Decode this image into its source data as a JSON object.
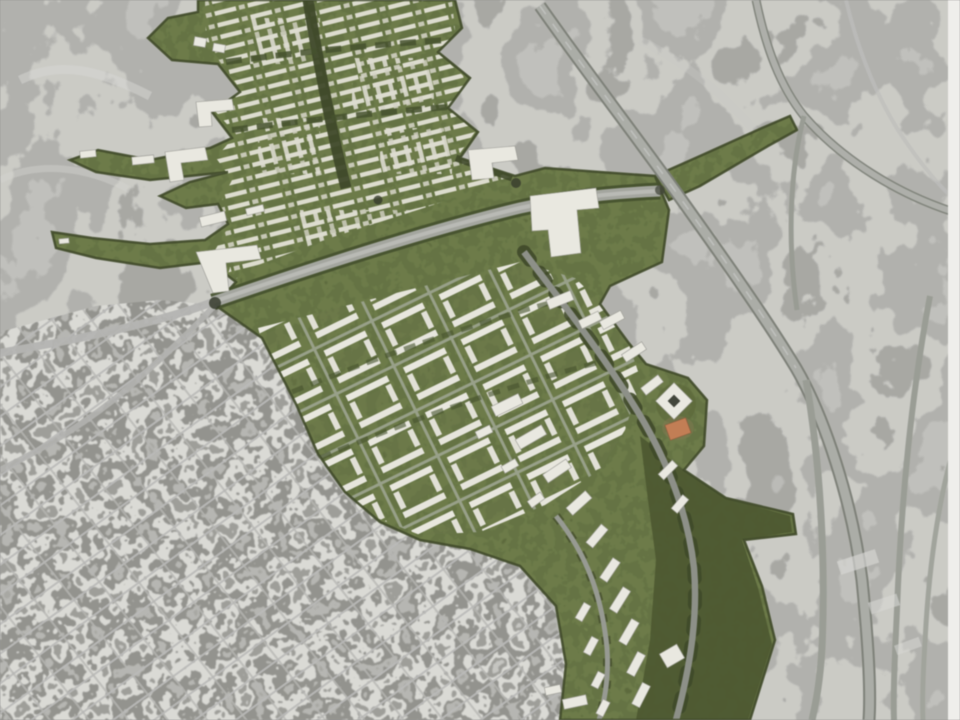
{
  "scene": {
    "kind": "aerial-masterplan-rendering",
    "aria_label": "Bird's-eye aerial rendering: proposed green development corridor with white buildings overlaid on a grayscale aerial photograph of a city, hills and freeways"
  },
  "palette": {
    "terrain_gray": "#b3b2af",
    "urban_gray": "#a9a9a6",
    "freeway_gray": "#abada7",
    "freeway_edge": "#7e8179",
    "arterial_gray": "#a4a69f",
    "plan_green": "#75804d",
    "tree_green": "#3f4a28",
    "woodland_green": "#4d5930",
    "building_white": "#eae9e1",
    "accent_orange": "#c47e53",
    "right_edge_strip": "#f0efec"
  },
  "features": {
    "hills_northwest": "undeveloped hills",
    "freeway_east": "freeway corridor and interchange ramps",
    "city_southwest": "existing dense city fabric",
    "plan_upper_grid": "proposed fine residential grid with tree boulevard",
    "plan_central_blocks": "proposed perimeter-block quarter",
    "plan_south_boulevard": "proposed curving boulevard with slab buildings",
    "plan_woodland": "proposed woodland swath",
    "arterial": "tree-lined arterial road crossing the plan",
    "landmark_building": "large white landmark building",
    "diamond_building": "diamond-shaped courtyard building",
    "orange_building": "orange accent building",
    "green_tendrils": "green fingers reaching into the hills"
  }
}
